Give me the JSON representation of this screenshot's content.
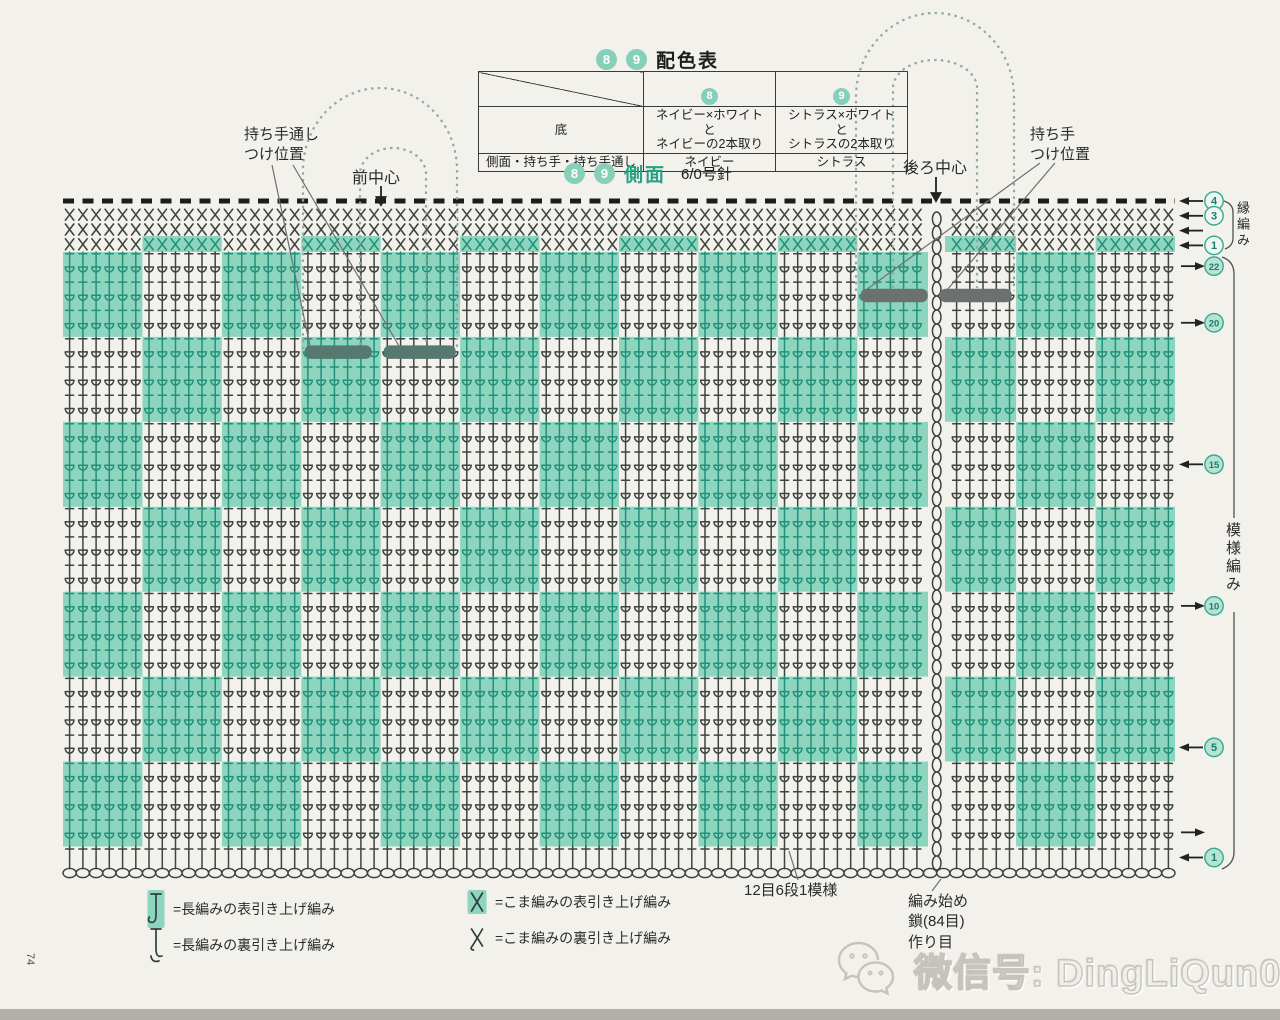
{
  "page": {
    "corner_mark": "74"
  },
  "colors": {
    "background": "#f2f1ec",
    "teal_block": "#8ed5c0",
    "teal_stitch": "#23907a",
    "dark_stitch": "#3e443f",
    "badge_fill": "#86d0ba",
    "circle_ring": "#35a98c",
    "circle_fill": "#b7e2d4",
    "circle_text": "#17806a",
    "accent_text": "#28a084",
    "handle_dots": "#93a8a0",
    "slot_bar_front": "#56796f",
    "slot_bar_back": "#6a716e",
    "chain_stitch": "#3f3f3f",
    "dash_row": "#1c1c1c",
    "watermark_outline": "#c6c3bc"
  },
  "color_table": {
    "title": "配色表",
    "title_badges": [
      "8",
      "9"
    ],
    "col_badges": [
      "8",
      "9"
    ],
    "rows": [
      {
        "label": "底",
        "col8": "ネイビー×ホワイトと\nネイビーの2本取り",
        "col9": "シトラス×ホワイトと\nシトラスの2本取り"
      },
      {
        "label": "側面・持ち手・持ち手通し",
        "col8": "ネイビー",
        "col9": "シトラス"
      }
    ]
  },
  "section": {
    "badges": [
      "8",
      "9"
    ],
    "title": "側面",
    "needle": "6/0号針"
  },
  "labels": {
    "handle_through": "持ち手通し\nつけ位置",
    "front_center": "前中心",
    "back_center": "後ろ中心",
    "handle_attach": "持ち手\nつけ位置",
    "edge_band": "縁編み",
    "pattern_band": "模様編み",
    "repeat_note": "12目6段1模様",
    "start_note": "編み始め\n鎖(84目)\n作り目"
  },
  "legend": {
    "items": [
      {
        "symbol": "dc-front-post-raised",
        "highlighted": true,
        "label": "=長編みの表引き上げ編み"
      },
      {
        "symbol": "sc-front-post-raised",
        "highlighted": true,
        "label": "=こま編みの表引き上げ編み"
      },
      {
        "symbol": "dc-back-post-raised",
        "highlighted": false,
        "label": "=長編みの裏引き上げ編み"
      },
      {
        "symbol": "sc-back-post-raised",
        "highlighted": false,
        "label": "=こま編みの裏引き上げ編み"
      }
    ]
  },
  "watermark": {
    "service": "WeChat",
    "text": "微信号: DingLiQun0830"
  },
  "chart": {
    "stitches": 84,
    "block_stitches": 6,
    "blocks": 14,
    "pattern_rows": 22,
    "symbol_rows": 21,
    "band_rows": 3,
    "edge_sc_rows": 3,
    "front_center_stitch": 24,
    "back_center_stitch": 66,
    "first_block_teal": true,
    "edge_row1_inverse_teal": true,
    "handle_slots": [
      {
        "side": "front",
        "row": 19
      },
      {
        "side": "back",
        "row": 21
      }
    ],
    "edge_row_markers": [
      {
        "row": 4,
        "num": "4",
        "dir": "left"
      },
      {
        "row": 3,
        "num": "3",
        "dir": "left"
      },
      {
        "row": 2,
        "num": "",
        "dir": "left"
      },
      {
        "row": 1,
        "num": "1",
        "dir": "left"
      }
    ],
    "pattern_row_markers": [
      {
        "row": 22,
        "num": "22",
        "dir": "right"
      },
      {
        "row": 20,
        "num": "20",
        "dir": "right"
      },
      {
        "row": 15,
        "num": "15",
        "dir": "left"
      },
      {
        "row": 10,
        "num": "10",
        "dir": "right"
      },
      {
        "row": 5,
        "num": "5",
        "dir": "left"
      },
      {
        "row": 2,
        "num": "",
        "dir": "right"
      },
      {
        "row": 1,
        "num": "1",
        "dir": "left"
      }
    ]
  }
}
